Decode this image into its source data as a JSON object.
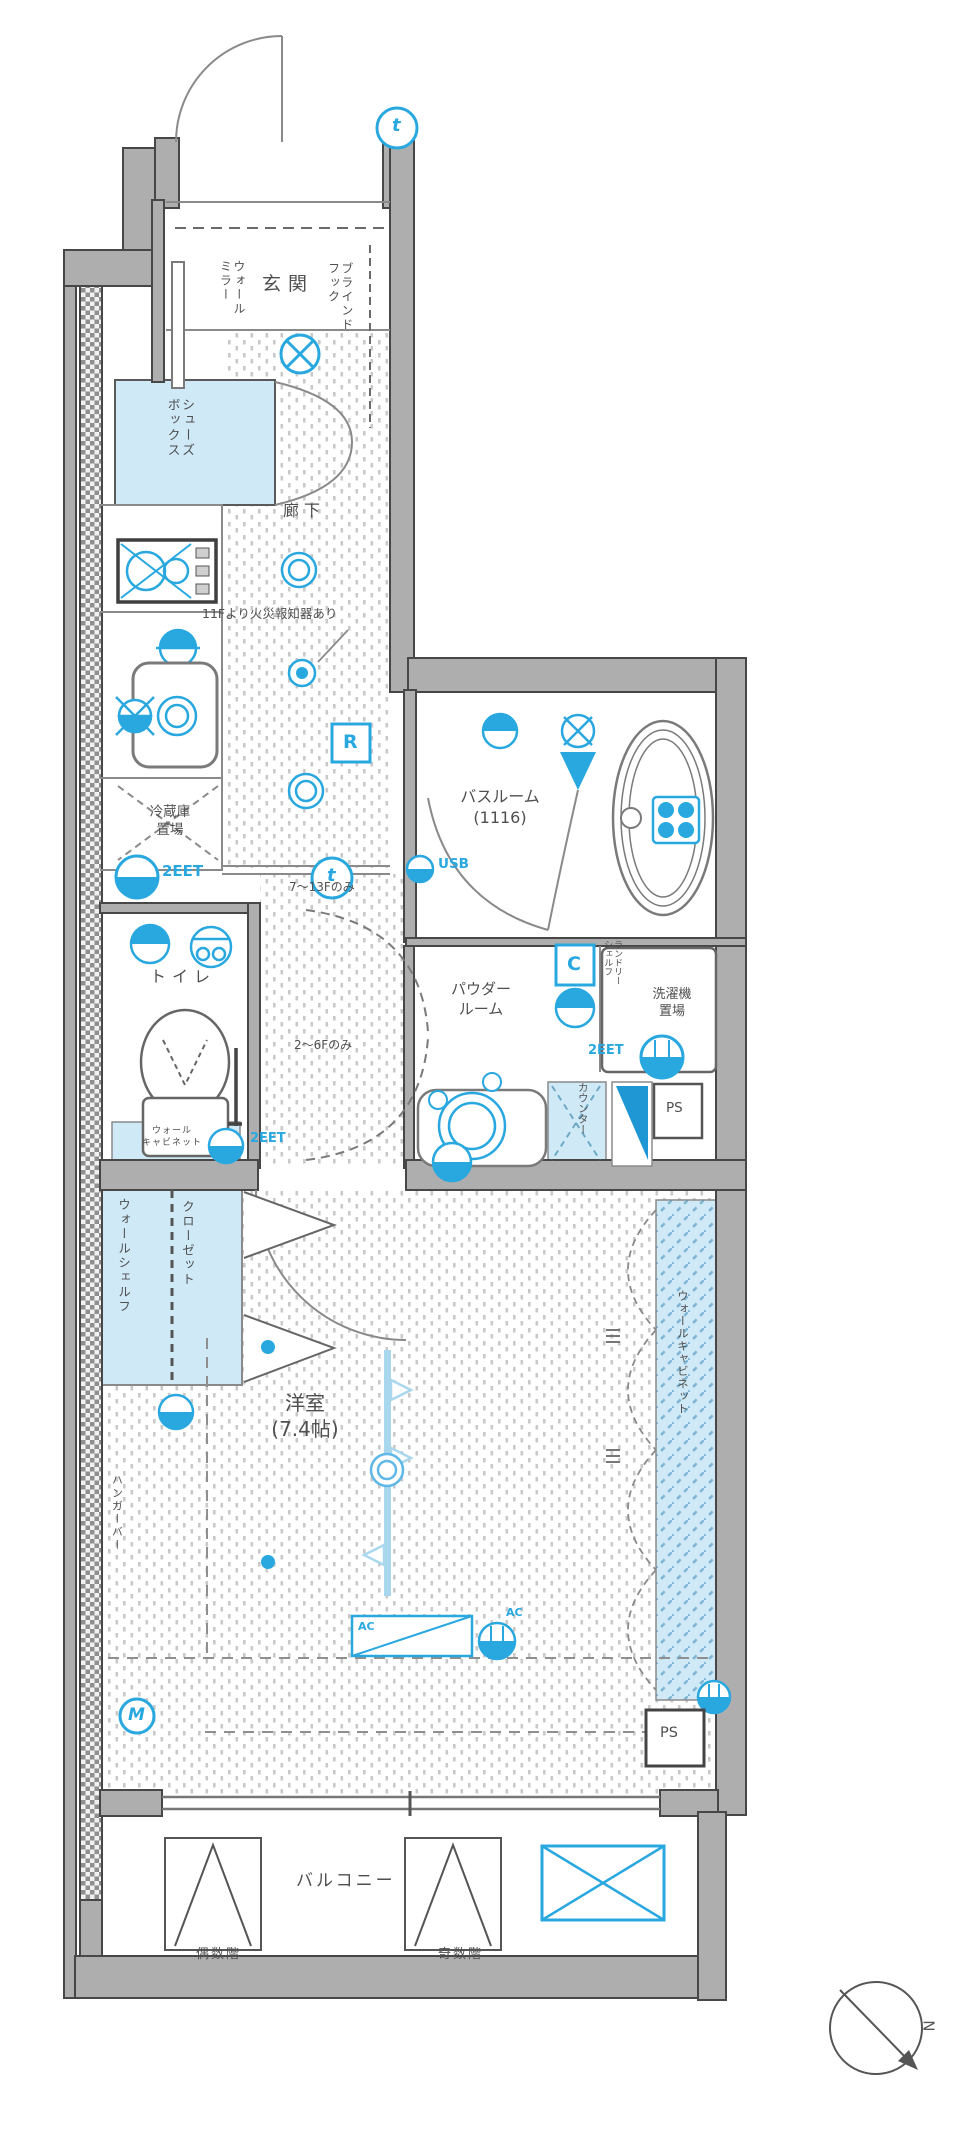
{
  "title": "間取り図",
  "rooms": {
    "entrance": "玄関",
    "hallway": "廊下",
    "bathroom": "バスルーム\n(1116)",
    "toilet": "トイレ",
    "powder_room": "パウダー\nルーム",
    "laundry": "洗濯機\n置場",
    "fridge": "冷蔵庫\n置場",
    "bedroom": "洋室\n(7.4帖)",
    "balcony": "バルコニー"
  },
  "fixtures": {
    "shoes_box": "シューズ\nボックス",
    "wall_mirror": "ウォール\nミラー",
    "blind_hook": "ブラインド\nフック",
    "closet": "クローゼット",
    "wall_shelf": "ウォールシェルフ",
    "toilet_cabinet": "ウォール\nキャビネット",
    "laundry_shelf": "ランドリー\nシェルフ",
    "counter": "カウンター",
    "hanger_bar": "ハンガーバー",
    "wall_cabinet": "ウォールキャビネット",
    "ps_upper": "PS",
    "ps_lower": "PS"
  },
  "notes": {
    "fire_alarm": "11Fより火災報知器あり",
    "floors_7_13": "7〜13Fのみ",
    "floors_2_6": "2〜6Fのみ",
    "even_floor": "偶数階",
    "odd_floor": "奇数階"
  },
  "symbols": {
    "outlet_kitchen": "2EET",
    "outlet_toilet": "2EET",
    "outlet_laundry": "2EET",
    "usb": "USB",
    "ac_unit": "AC",
    "ac_outlet": "AC",
    "remote": "R",
    "circuit": "C",
    "thermo_top": "t",
    "thermo_hall": "t",
    "meter": "M",
    "north": "N"
  },
  "colors": {
    "accent_blue": "#29a8e0",
    "light_blue": "#cfe9f7",
    "pale_blue": "#a9d7ee",
    "wall_gray": "#aeaeae",
    "line_gray": "#474747",
    "text_gray": "#4f4f4f"
  }
}
